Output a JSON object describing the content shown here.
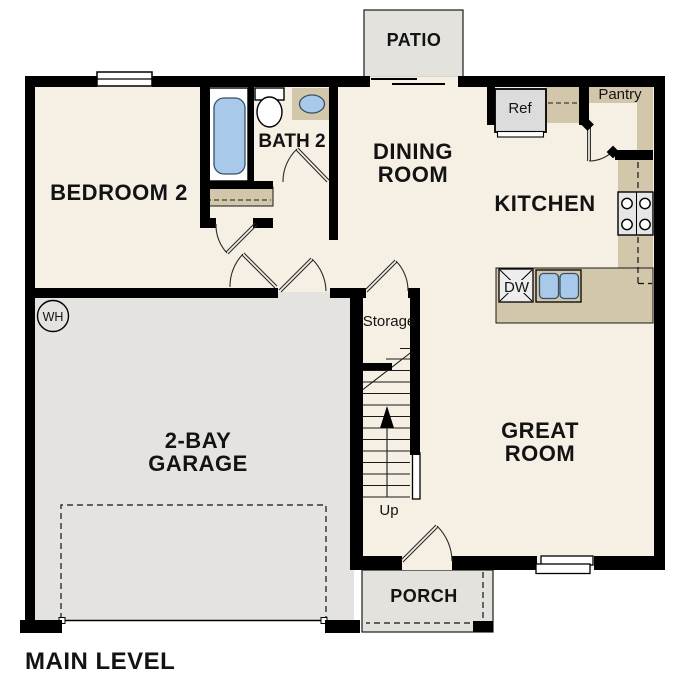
{
  "plan": {
    "title": "MAIN LEVEL",
    "rooms": {
      "bedroom2": {
        "label": "BEDROOM 2"
      },
      "bath2": {
        "label": "BATH 2"
      },
      "dining": {
        "line1": "DINING",
        "line2": "ROOM"
      },
      "kitchen": {
        "label": "KITCHEN"
      },
      "great_room": {
        "line1": "GREAT",
        "line2": "ROOM"
      },
      "garage": {
        "line1": "2-BAY",
        "line2": "GARAGE"
      },
      "patio": {
        "label": "PATIO"
      },
      "porch": {
        "label": "PORCH"
      },
      "storage": {
        "label": "Storage"
      }
    },
    "fixtures": {
      "refrigerator": "Ref",
      "pantry": "Pantry",
      "dishwasher": "DW",
      "water_heater": "WH",
      "stairs_direction": "Up"
    },
    "colors": {
      "wall": "#000000",
      "interior_floor": "#f6efe3",
      "garage_floor": "#e4e3df",
      "outdoor_concrete": "#e3e2dd",
      "counter_tan": "#d3c7ab",
      "fixture_blue": "#a9c9ea",
      "appliance_gray": "#dcdcdc"
    }
  }
}
